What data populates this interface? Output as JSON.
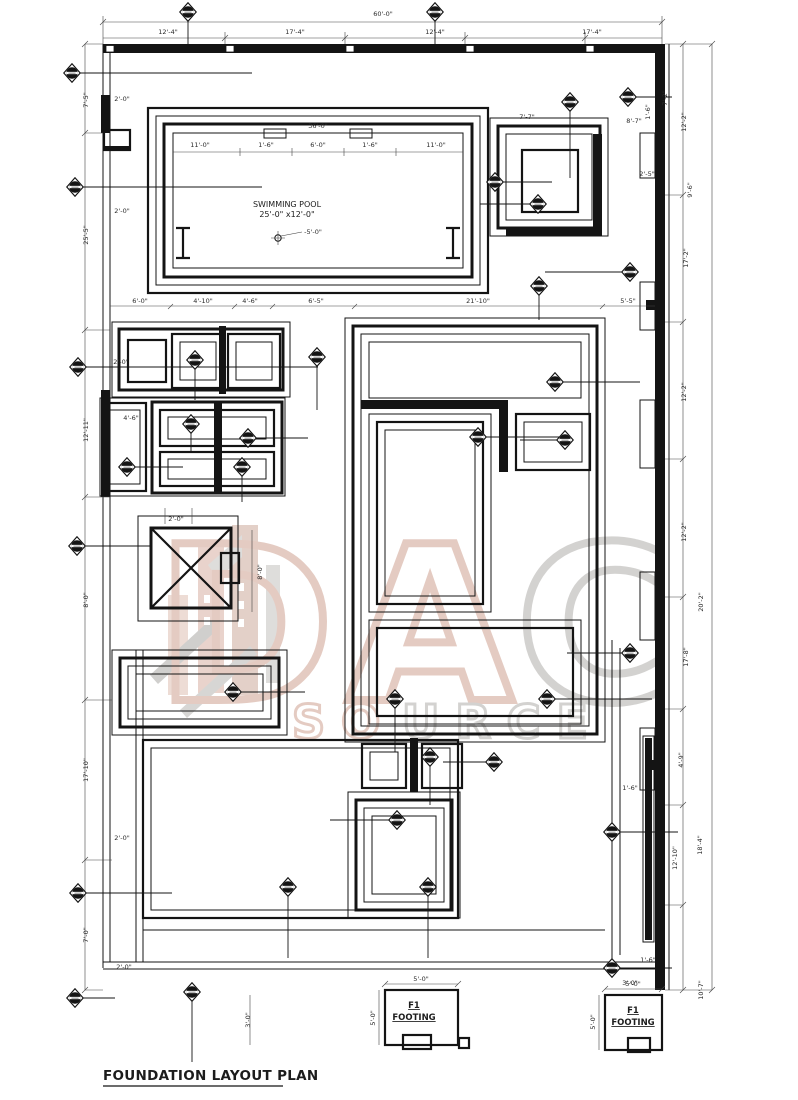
{
  "title": "FOUNDATION LAYOUT PLAN",
  "pool": {
    "name": "SWIMMING POOL",
    "size": "25'-0\" x12'-0\"",
    "depth": "-5'-0\""
  },
  "footings": [
    {
      "id": "F1",
      "label": "FOOTING",
      "top": "5'-0\"",
      "side": "5'-0\""
    },
    {
      "id": "F1",
      "label": "FOOTING",
      "top": "5'-0\"",
      "side": "5'-0\""
    }
  ],
  "watermark": {
    "letters": [
      "D",
      "A",
      "C"
    ],
    "word_part1": "SO",
    "word_part2": "URCE",
    "color_tan": "#cfa292",
    "color_gray": "#b0aeab"
  },
  "marker_symbol": "footing-column-marker",
  "dim_labels": [
    {
      "x": 383,
      "y": 16,
      "r": 0,
      "t": "60'-0\""
    },
    {
      "x": 168,
      "y": 34,
      "r": 0,
      "t": "12'-4\""
    },
    {
      "x": 295,
      "y": 34,
      "r": 0,
      "t": "17'-4\""
    },
    {
      "x": 435,
      "y": 34,
      "r": 0,
      "t": "12'-4\""
    },
    {
      "x": 592,
      "y": 34,
      "r": 0,
      "t": "17'-4\""
    },
    {
      "x": 318,
      "y": 128,
      "r": 0,
      "t": "36'-0\""
    },
    {
      "x": 200,
      "y": 147,
      "r": 0,
      "t": "11'-0\""
    },
    {
      "x": 266,
      "y": 147,
      "r": 0,
      "t": "1'-6\""
    },
    {
      "x": 318,
      "y": 147,
      "r": 0,
      "t": "6'-0\""
    },
    {
      "x": 370,
      "y": 147,
      "r": 0,
      "t": "1'-6\""
    },
    {
      "x": 436,
      "y": 147,
      "r": 0,
      "t": "11'-0\""
    },
    {
      "x": 527,
      "y": 119,
      "r": 0,
      "t": "7'-7\""
    },
    {
      "x": 634,
      "y": 123,
      "r": 0,
      "t": "8'-7\""
    },
    {
      "x": 650,
      "y": 112,
      "r": -90,
      "t": "1'-6\""
    },
    {
      "x": 647,
      "y": 176,
      "r": 0,
      "t": "2'-5\""
    },
    {
      "x": 140,
      "y": 303,
      "r": 0,
      "t": "6'-0\""
    },
    {
      "x": 203,
      "y": 303,
      "r": 0,
      "t": "4'-10\""
    },
    {
      "x": 250,
      "y": 303,
      "r": 0,
      "t": "4'-6\""
    },
    {
      "x": 316,
      "y": 303,
      "r": 0,
      "t": "6'-5\""
    },
    {
      "x": 478,
      "y": 303,
      "r": 0,
      "t": "21'-10\""
    },
    {
      "x": 628,
      "y": 303,
      "r": 0,
      "t": "5'-5\""
    },
    {
      "x": 88,
      "y": 100,
      "r": -90,
      "t": "7'-5\""
    },
    {
      "x": 88,
      "y": 235,
      "r": -90,
      "t": "25'-5\""
    },
    {
      "x": 88,
      "y": 430,
      "r": -90,
      "t": "12'-11\""
    },
    {
      "x": 88,
      "y": 600,
      "r": -90,
      "t": "8'-0\""
    },
    {
      "x": 88,
      "y": 770,
      "r": -90,
      "t": "17'-10\""
    },
    {
      "x": 88,
      "y": 935,
      "r": -90,
      "t": "7'-0\""
    },
    {
      "x": 122,
      "y": 101,
      "r": 0,
      "t": "2'-0\""
    },
    {
      "x": 122,
      "y": 213,
      "r": 0,
      "t": "2'-0\""
    },
    {
      "x": 121,
      "y": 364,
      "r": 0,
      "t": "2'-0\""
    },
    {
      "x": 131,
      "y": 420,
      "r": 0,
      "t": "4'-6\""
    },
    {
      "x": 122,
      "y": 840,
      "r": 0,
      "t": "2'-0\""
    },
    {
      "x": 124,
      "y": 969,
      "r": 0,
      "t": "2'-0\""
    },
    {
      "x": 176,
      "y": 521,
      "r": 0,
      "t": "2'-0\""
    },
    {
      "x": 262,
      "y": 572,
      "r": -90,
      "t": "8'-0\""
    },
    {
      "x": 667,
      "y": 98,
      "r": -90,
      "t": "7'-2\""
    },
    {
      "x": 686,
      "y": 122,
      "r": -90,
      "t": "12'-2\""
    },
    {
      "x": 692,
      "y": 190,
      "r": -90,
      "t": "9'-6\""
    },
    {
      "x": 688,
      "y": 258,
      "r": -90,
      "t": "17'-2\""
    },
    {
      "x": 686,
      "y": 392,
      "r": -90,
      "t": "12'-2\""
    },
    {
      "x": 686,
      "y": 532,
      "r": -90,
      "t": "12'-2\""
    },
    {
      "x": 703,
      "y": 602,
      "r": -90,
      "t": "20'-2\""
    },
    {
      "x": 688,
      "y": 657,
      "r": -90,
      "t": "17'-8\""
    },
    {
      "x": 683,
      "y": 760,
      "r": -90,
      "t": "4'-9\""
    },
    {
      "x": 702,
      "y": 845,
      "r": -90,
      "t": "18'-4\""
    },
    {
      "x": 677,
      "y": 858,
      "r": -90,
      "t": "12'-10\""
    },
    {
      "x": 703,
      "y": 990,
      "r": -90,
      "t": "10'-7\""
    },
    {
      "x": 630,
      "y": 790,
      "r": 0,
      "t": "1'-6\""
    },
    {
      "x": 648,
      "y": 962,
      "r": 0,
      "t": "1'-6\""
    },
    {
      "x": 630,
      "y": 985,
      "r": 0,
      "t": "3'-0\""
    },
    {
      "x": 250,
      "y": 1020,
      "r": -90,
      "t": "3'-0\""
    }
  ],
  "markers": [
    {
      "x": 188,
      "y": 12,
      "x2": 188,
      "y2": 53
    },
    {
      "x": 435,
      "y": 12,
      "x2": 435,
      "y2": 53
    },
    {
      "x": 72,
      "y": 73,
      "x2": 252,
      "y2": 73
    },
    {
      "x": 75,
      "y": 187,
      "x2": 262,
      "y2": 187
    },
    {
      "x": 78,
      "y": 367,
      "x2": 318,
      "y2": 367
    },
    {
      "x": 77,
      "y": 546,
      "x2": 152,
      "y2": 546
    },
    {
      "x": 78,
      "y": 893,
      "x2": 172,
      "y2": 893
    },
    {
      "x": 75,
      "y": 998,
      "x2": 115,
      "y2": 998
    },
    {
      "x": 628,
      "y": 97,
      "x2": 672,
      "y2": 97
    },
    {
      "x": 570,
      "y": 102,
      "x2": 570,
      "y2": 178
    },
    {
      "x": 495,
      "y": 182,
      "x2": 552,
      "y2": 182
    },
    {
      "x": 538,
      "y": 204,
      "x2": 480,
      "y2": 204
    },
    {
      "x": 630,
      "y": 272,
      "x2": 545,
      "y2": 272
    },
    {
      "x": 539,
      "y": 286,
      "x2": 539,
      "y2": 320
    },
    {
      "x": 317,
      "y": 357,
      "x2": 317,
      "y2": 410
    },
    {
      "x": 195,
      "y": 360,
      "x2": 195,
      "y2": 400
    },
    {
      "x": 555,
      "y": 382,
      "x2": 640,
      "y2": 382
    },
    {
      "x": 191,
      "y": 424,
      "x2": 191,
      "y2": 452
    },
    {
      "x": 248,
      "y": 438,
      "x2": 308,
      "y2": 438
    },
    {
      "x": 242,
      "y": 467,
      "x2": 242,
      "y2": 502
    },
    {
      "x": 127,
      "y": 467,
      "x2": 183,
      "y2": 467
    },
    {
      "x": 478,
      "y": 437,
      "x2": 560,
      "y2": 437
    },
    {
      "x": 565,
      "y": 440,
      "x2": 520,
      "y2": 440
    },
    {
      "x": 233,
      "y": 692,
      "x2": 305,
      "y2": 692
    },
    {
      "x": 395,
      "y": 699,
      "x2": 395,
      "y2": 752
    },
    {
      "x": 547,
      "y": 699,
      "x2": 652,
      "y2": 699
    },
    {
      "x": 630,
      "y": 653,
      "x2": 567,
      "y2": 653
    },
    {
      "x": 430,
      "y": 757,
      "x2": 430,
      "y2": 805
    },
    {
      "x": 494,
      "y": 762,
      "x2": 443,
      "y2": 762
    },
    {
      "x": 397,
      "y": 820,
      "x2": 330,
      "y2": 820
    },
    {
      "x": 288,
      "y": 887,
      "x2": 288,
      "y2": 958
    },
    {
      "x": 428,
      "y": 887,
      "x2": 428,
      "y2": 958
    },
    {
      "x": 612,
      "y": 832,
      "x2": 678,
      "y2": 832
    },
    {
      "x": 612,
      "y": 968,
      "x2": 672,
      "y2": 968
    },
    {
      "x": 192,
      "y": 992,
      "x2": 192,
      "y2": 1062
    }
  ]
}
